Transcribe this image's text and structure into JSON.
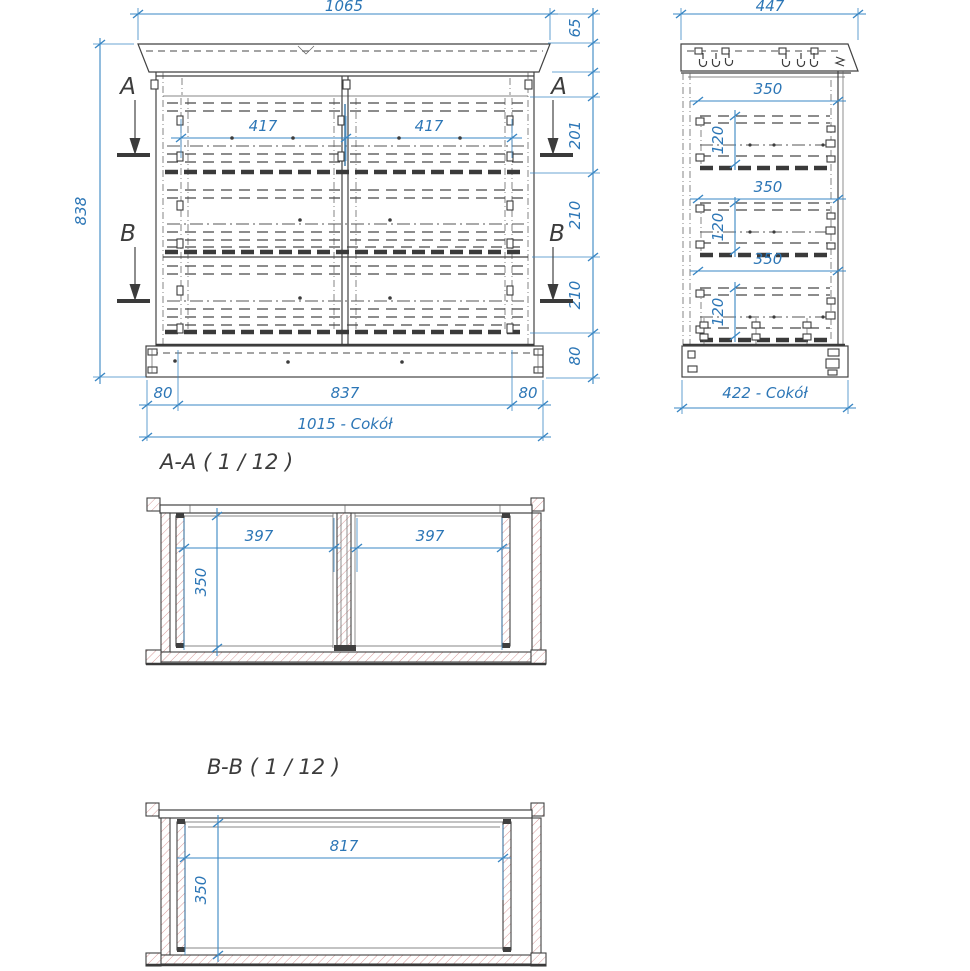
{
  "drawing": {
    "type": "furniture technical drawing (chest of drawers)",
    "colors": {
      "dimension_blue": "#3a87c4",
      "line_dark": "#424242",
      "hatch_red": "#d79a9a",
      "background": "#ffffff"
    }
  },
  "front_view": {
    "dim_width_top": "1065",
    "dim_height_left": "838",
    "dim_drawer_left": "417",
    "dim_drawer_right": "417",
    "dims_right": [
      "65",
      "201",
      "210",
      "210",
      "80"
    ],
    "dims_bottom": [
      "80",
      "837",
      "80"
    ],
    "dim_plinth": "1015 - Cokół",
    "section_a": "A",
    "section_b": "B"
  },
  "side_view": {
    "dim_width_top": "447",
    "dim_depths": [
      "350",
      "350",
      "350"
    ],
    "dim_heights": [
      "120",
      "120",
      "120"
    ],
    "dim_plinth": "422 - Cokół"
  },
  "section_aa": {
    "title": "A-A ( 1 / 12 )",
    "dim_left": "397",
    "dim_right": "397",
    "dim_depth": "350"
  },
  "section_bb": {
    "title": "B-B ( 1 / 12 )",
    "dim_width": "817",
    "dim_depth": "350"
  }
}
